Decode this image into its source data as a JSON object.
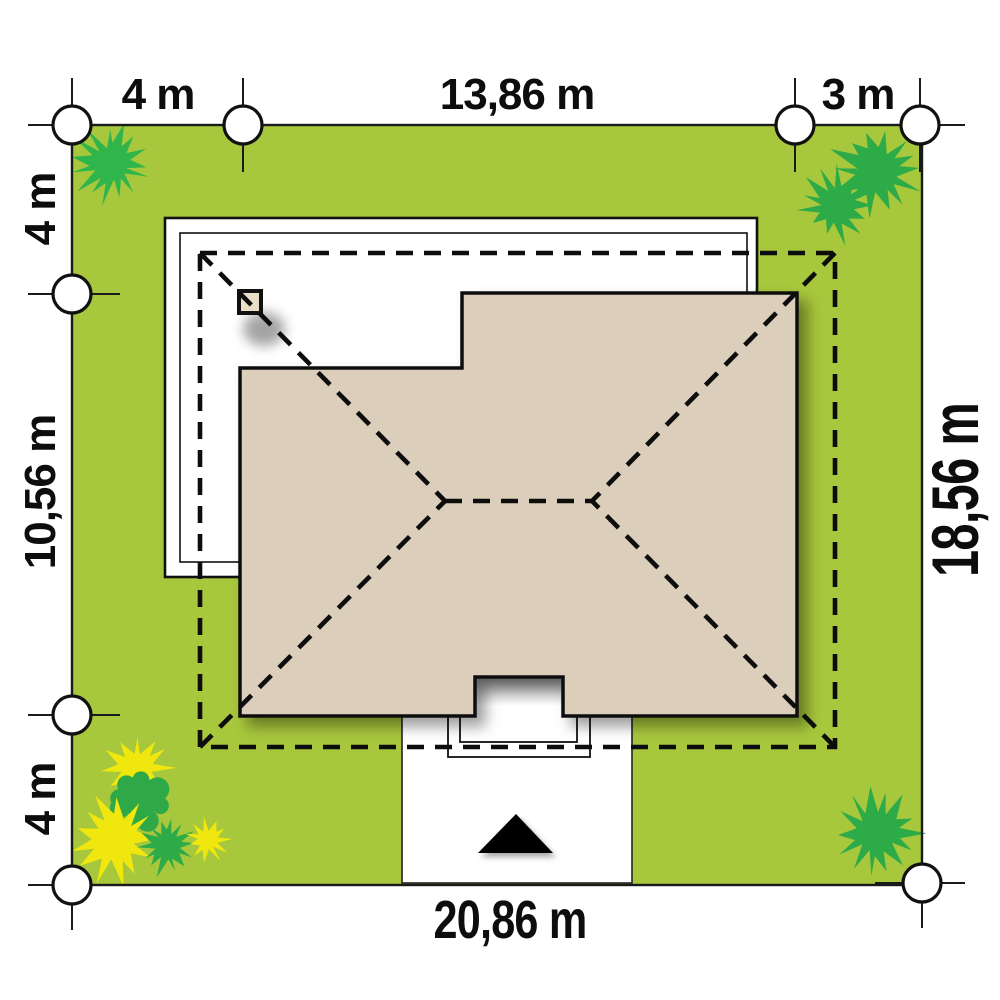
{
  "site_plan": {
    "title": "house site plan",
    "dimensions": {
      "top_left": "4 m",
      "top_center": "13,86 m",
      "top_right": "3 m",
      "left_top": "4 m",
      "left_middle": "10,56 m",
      "left_bottom": "4 m",
      "right_side": "18,56 m",
      "bottom": "20,86 m"
    },
    "colors": {
      "lawn": "#a7c73c",
      "roof": "#dbceba",
      "chimney": "#e9dfc6",
      "outline": "#111111",
      "bush_green_bright": "#2fb54c",
      "bush_green": "#2cab48",
      "bush_yellow": "#f0e70f",
      "paper": "#ffffff"
    },
    "bushes": [
      {
        "x": 111,
        "y": 164,
        "r": 39,
        "type": "spiky",
        "points": 15,
        "color": "#2fb54c",
        "seed": 1
      },
      {
        "x": 877,
        "y": 172,
        "r": 46,
        "type": "spiky",
        "points": 14,
        "color": "#2cab48",
        "seed": 2
      },
      {
        "x": 836,
        "y": 205,
        "r": 36,
        "type": "spiky",
        "points": 13,
        "color": "#2cab48",
        "seed": 3
      },
      {
        "x": 137,
        "y": 769,
        "r": 36,
        "type": "spiky",
        "points": 12,
        "color": "#f0e70f",
        "seed": 4
      },
      {
        "x": 140,
        "y": 801,
        "r": 34,
        "type": "lobed",
        "points": 8,
        "color": "#2fa948",
        "seed": 5
      },
      {
        "x": 115,
        "y": 838,
        "r": 44,
        "type": "spiky",
        "points": 13,
        "color": "#f0e70f",
        "seed": 6
      },
      {
        "x": 167,
        "y": 845,
        "r": 29,
        "type": "spiky",
        "points": 14,
        "color": "#2cab48",
        "seed": 7
      },
      {
        "x": 208,
        "y": 840,
        "r": 21,
        "type": "spiky",
        "points": 11,
        "color": "#f0e70f",
        "seed": 8
      },
      {
        "x": 877,
        "y": 833,
        "r": 43,
        "type": "spiky",
        "points": 14,
        "color": "#2cab48",
        "seed": 9
      }
    ]
  }
}
